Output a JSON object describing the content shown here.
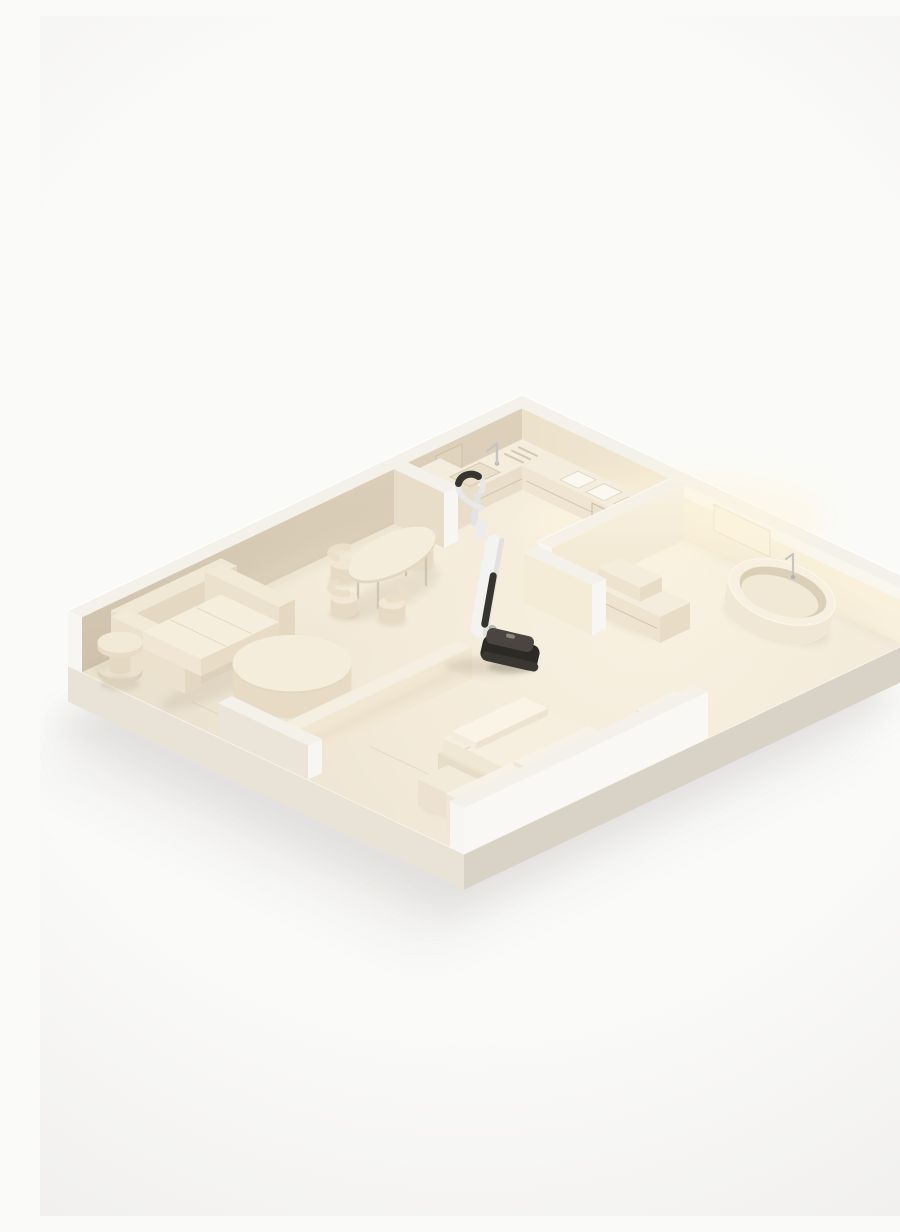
{
  "image": {
    "width": 900,
    "height": 1200,
    "description": "Isometric 3D render of a cream-colored miniature apartment cutaway model - living room with sofa and round tables, dining area with oval table and chairs, kitchen with L-shaped counter, bathroom with freestanding oval bathtub and vanity, bedroom with low platform bed - and a white cordless wet-dry vacuum cleaner standing upright near the center"
  },
  "palette": {
    "background": "#fafaf8",
    "vignette_edge": "#f1f0ee",
    "ground_shadow_near": "#e1e0de",
    "ground_shadow_far": "#edecea",
    "base_front_sw": "#e9e3d7",
    "base_front_se": "#d9d3c7",
    "base_edge_highlight": "#fdfcfa",
    "floor_light": "#f8f1e1",
    "floor_mid": "#f3ead9",
    "floor_dark": "#eae1cf",
    "floor_seam": "#ddd2bd",
    "wall_nw_top": "#ddd0bb",
    "wall_nw_bottom": "#ccbfa9",
    "wall_nw_panel": "#e0d3be",
    "wall_ne_left": "#ece1cb",
    "wall_ne_mid": "#f3e9d4",
    "wall_ne_right": "#f9f0dd",
    "wall_top_face": "#f4f1ea",
    "wall_end_cap": "#f7f6f2",
    "wall_se_outer": "#f9f8f5",
    "wall_b_top": "#faf3e2",
    "wall_b_bottom": "#efe4cd",
    "wall_c_face": "#f5ecd8",
    "partition_face": "#e8ddc8",
    "low_wall_face": "#f1e7d3",
    "panel_face": "#f1e9da",
    "panel_top": "#f7f2e8",
    "panel_side": "#eee7d8",
    "glow": "#fff6dd",
    "glow_floor": "#fbf3e0",
    "counter_top": "#f4ecdc",
    "counter_front": "#e9deca",
    "counter_side": "#efe5d2",
    "cabinet_seam": "#cdc0aa",
    "oven_fill": "#ece1cc",
    "oven_stroke": "#c9bca6",
    "sink_fill": "#eadfcb",
    "sink_stroke": "#d5c9b3",
    "cooktop_pad": "#fbf8f0",
    "cooktop_stroke": "#ddd2bd",
    "trivet_bar": "#d3c7b1",
    "metal": "#c6c5c1",
    "metal_dark": "#b4b3af",
    "sofa_top": "#f2e9d7",
    "sofa_front": "#e4d8c2",
    "sofa_side": "#ece1cd",
    "sofa_back_top": "#f0e7d5",
    "cushion_top": "#f5eedd",
    "cushion_front": "#e8dcc6",
    "cushion_side": "#f0e6d3",
    "cushion_seam": "#e2d6c0",
    "plinth": "#ddd1bb",
    "table_top": "#f5eddc",
    "table_edge": "#e3d7c1",
    "table_side": "#e7dbc5",
    "leg": "#d2c6b0",
    "chair_top": "#f1e7d4",
    "chair_side": "#e6dac4",
    "chair_back": "#ebdfc9",
    "tub_body": "#f0e7d4",
    "tub_rim": "#f7f0e0",
    "tub_inner_wall": "#dccfb7",
    "tub_inner_floor": "#f1e8d6",
    "tub_highlight": "#fbf6ea",
    "bed_platform_top": "#ece2cd",
    "bed_platform_front": "#dfd3bd",
    "bed_platform_side": "#e7dcc7",
    "mattress_top": "#f6efe0",
    "mattress_front": "#e9dec9",
    "mattress_side": "#f0e7d5",
    "mattress_crease": "#e4d9c3",
    "pillow": "#faf4e7",
    "pillow_front": "#eee3d0",
    "pillow_side": "#f3ebdc",
    "night_top": "#f3ebda",
    "night_front": "#e5dac4",
    "night_side": "#ede2cf",
    "stool_ring": "#f4ecdc",
    "stool_ring_stroke": "#d8ccb7",
    "stool_leg": "#cabdaa",
    "vacuum_white": "#f3f3f1",
    "vacuum_shade": "#d9d9d7",
    "vacuum_gray": "#e7e8e7",
    "vacuum_pole": "#e2e3e2",
    "vacuum_joint": "#ebeceb",
    "vacuum_grip": "#38342f",
    "vacuum_window": "#36342f",
    "vacuum_head": "#2c2a27",
    "vacuum_head_top": "#4a4540",
    "vacuum_head_lip": "#3a3733",
    "vacuum_neck": "#b7b6b3",
    "contact_shadow": "#8f7e62",
    "white_edge": "#ffffff"
  },
  "scene": {
    "labels": {
      "ground_shadow": "Soft shadow cast by the apartment model on the white ground",
      "base": "Cream display base slab of the miniature apartment model",
      "floor": "Warm cream apartment floor with faint plank seams",
      "outer_walls": "Tall back perimeter walls, shaded on the left, warmly lit on the right",
      "kitchen": "Kitchen with L-shaped counter, sink, faucet, trivet bars, cooktop pads and oven front",
      "bathroom": "Bathroom with freestanding oval bathtub, floor faucet, two-tier vanity and lit partition walls",
      "dining_area": "Dining area with oval pedestal table and four shell chairs",
      "living_room": "Living room with three-seat sofa, spool side table, round coffee table and wire side table",
      "bedroom": "Bedroom with low partition wall, platform bed, wide pillow, bedside cube and wardrobe panels",
      "front_walls": "Low front wall segments along the near edges of the model",
      "vacuum": "White cordless wet-dry vacuum cleaner standing upright in the middle of the apartment"
    }
  }
}
